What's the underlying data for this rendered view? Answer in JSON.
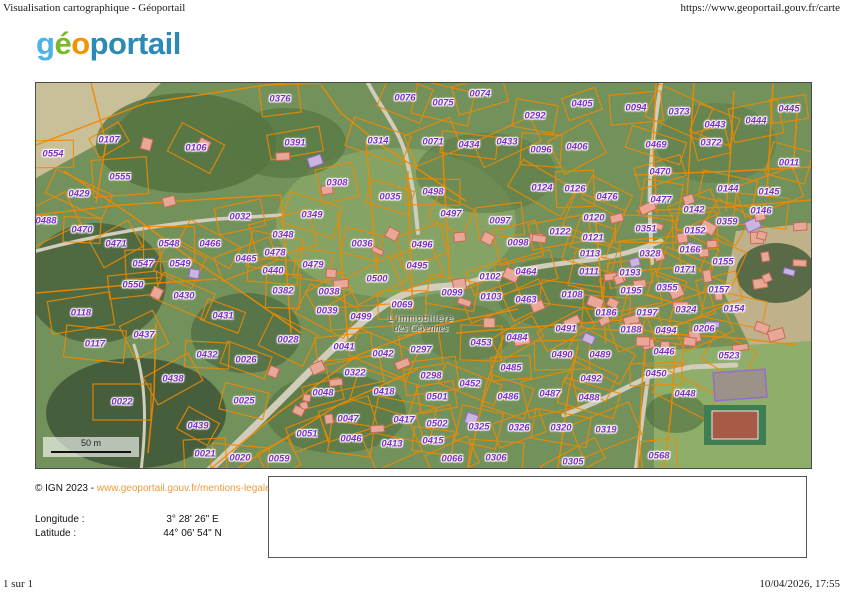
{
  "header": {
    "doc_title": "Visualisation cartographique - Géoportail",
    "url": "https://www.geoportail.gouv.fr/carte"
  },
  "logo": {
    "parts": [
      {
        "t": "g",
        "c": "#4db3e6"
      },
      {
        "t": "é",
        "c": "#7ab829"
      },
      {
        "t": "o",
        "c": "#f29400"
      },
      {
        "t": "portail",
        "c": "#2d89b5"
      }
    ]
  },
  "map": {
    "colors": {
      "parcel_line": "#f08a00",
      "parcel_label": "#7d2cc8",
      "building_fill": "#e7a898",
      "building_stroke": "#c96a57",
      "public_building_stroke": "#9a6ad0",
      "marker": "#f2a33c"
    },
    "place_label": {
      "line1": "L'immobilière",
      "line2": "des Cévennes"
    },
    "scale_bar": {
      "label": "50 m"
    },
    "parcels": [
      {
        "t": "0107",
        "x": 73,
        "y": 57
      },
      {
        "t": "0554",
        "x": 17,
        "y": 71
      },
      {
        "t": "0106",
        "x": 160,
        "y": 65
      },
      {
        "t": "0555",
        "x": 84,
        "y": 94
      },
      {
        "t": "0429",
        "x": 43,
        "y": 111
      },
      {
        "t": "0376",
        "x": 244,
        "y": 16
      },
      {
        "t": "0076",
        "x": 369,
        "y": 15
      },
      {
        "t": "0391",
        "x": 259,
        "y": 60
      },
      {
        "t": "0314",
        "x": 342,
        "y": 58
      },
      {
        "t": "0308",
        "x": 301,
        "y": 100
      },
      {
        "t": "0035",
        "x": 354,
        "y": 114
      },
      {
        "t": "0074",
        "x": 444,
        "y": 11
      },
      {
        "t": "0075",
        "x": 407,
        "y": 20
      },
      {
        "t": "0405",
        "x": 546,
        "y": 21
      },
      {
        "t": "0292",
        "x": 499,
        "y": 33
      },
      {
        "t": "0071",
        "x": 397,
        "y": 59
      },
      {
        "t": "0434",
        "x": 433,
        "y": 62
      },
      {
        "t": "0433",
        "x": 471,
        "y": 59
      },
      {
        "t": "0096",
        "x": 505,
        "y": 67
      },
      {
        "t": "0406",
        "x": 541,
        "y": 64
      },
      {
        "t": "0498",
        "x": 397,
        "y": 109
      },
      {
        "t": "0124",
        "x": 506,
        "y": 105
      },
      {
        "t": "0126",
        "x": 539,
        "y": 106
      },
      {
        "t": "0476",
        "x": 571,
        "y": 114
      },
      {
        "t": "0094",
        "x": 600,
        "y": 25
      },
      {
        "t": "0373",
        "x": 643,
        "y": 29
      },
      {
        "t": "0445",
        "x": 753,
        "y": 26
      },
      {
        "t": "0443",
        "x": 679,
        "y": 42
      },
      {
        "t": "0444",
        "x": 720,
        "y": 38
      },
      {
        "t": "0469",
        "x": 620,
        "y": 62
      },
      {
        "t": "0372",
        "x": 675,
        "y": 60
      },
      {
        "t": "0011",
        "x": 753,
        "y": 80
      },
      {
        "t": "0470",
        "x": 624,
        "y": 89
      },
      {
        "t": "0144",
        "x": 692,
        "y": 106
      },
      {
        "t": "0145",
        "x": 733,
        "y": 109
      },
      {
        "t": "0477",
        "x": 625,
        "y": 117
      },
      {
        "t": "0142",
        "x": 658,
        "y": 127
      },
      {
        "t": "0146",
        "x": 725,
        "y": 128
      },
      {
        "t": "0488",
        "x": 10,
        "y": 138
      },
      {
        "t": "0470",
        "x": 46,
        "y": 147
      },
      {
        "t": "0471",
        "x": 80,
        "y": 161
      },
      {
        "t": "0548",
        "x": 133,
        "y": 161
      },
      {
        "t": "0466",
        "x": 174,
        "y": 161
      },
      {
        "t": "0547",
        "x": 107,
        "y": 181
      },
      {
        "t": "0549",
        "x": 144,
        "y": 181
      },
      {
        "t": "0550",
        "x": 97,
        "y": 202
      },
      {
        "t": "0430",
        "x": 148,
        "y": 213
      },
      {
        "t": "0118",
        "x": 45,
        "y": 230
      },
      {
        "t": "0431",
        "x": 187,
        "y": 233
      },
      {
        "t": "0032",
        "x": 204,
        "y": 134
      },
      {
        "t": "0349",
        "x": 276,
        "y": 132
      },
      {
        "t": "0348",
        "x": 247,
        "y": 152
      },
      {
        "t": "0036",
        "x": 326,
        "y": 161
      },
      {
        "t": "0496",
        "x": 386,
        "y": 162
      },
      {
        "t": "0478",
        "x": 239,
        "y": 170
      },
      {
        "t": "0465",
        "x": 210,
        "y": 176
      },
      {
        "t": "0479",
        "x": 277,
        "y": 182
      },
      {
        "t": "0495",
        "x": 381,
        "y": 183
      },
      {
        "t": "0440",
        "x": 237,
        "y": 188
      },
      {
        "t": "0500",
        "x": 341,
        "y": 196
      },
      {
        "t": "0382",
        "x": 247,
        "y": 208
      },
      {
        "t": "0038",
        "x": 293,
        "y": 209
      },
      {
        "t": "0069",
        "x": 366,
        "y": 222
      },
      {
        "t": "0039",
        "x": 291,
        "y": 228
      },
      {
        "t": "0499",
        "x": 325,
        "y": 234
      },
      {
        "t": "0497",
        "x": 415,
        "y": 131
      },
      {
        "t": "0097",
        "x": 464,
        "y": 138
      },
      {
        "t": "0120",
        "x": 558,
        "y": 135
      },
      {
        "t": "0122",
        "x": 524,
        "y": 149
      },
      {
        "t": "0121",
        "x": 557,
        "y": 155
      },
      {
        "t": "0098",
        "x": 482,
        "y": 160
      },
      {
        "t": "0113",
        "x": 554,
        "y": 171
      },
      {
        "t": "0464",
        "x": 490,
        "y": 189
      },
      {
        "t": "0111",
        "x": 553,
        "y": 189
      },
      {
        "t": "0102",
        "x": 454,
        "y": 194
      },
      {
        "t": "0099",
        "x": 416,
        "y": 210
      },
      {
        "t": "0103",
        "x": 455,
        "y": 214
      },
      {
        "t": "0108",
        "x": 536,
        "y": 212
      },
      {
        "t": "0463",
        "x": 490,
        "y": 217
      },
      {
        "t": "0186",
        "x": 570,
        "y": 230
      },
      {
        "t": "0491",
        "x": 530,
        "y": 246
      },
      {
        "t": "0351",
        "x": 610,
        "y": 146
      },
      {
        "t": "0359",
        "x": 691,
        "y": 139
      },
      {
        "t": "0152",
        "x": 659,
        "y": 148
      },
      {
        "t": "0166",
        "x": 654,
        "y": 167
      },
      {
        "t": "0328",
        "x": 614,
        "y": 171
      },
      {
        "t": "0155",
        "x": 687,
        "y": 179
      },
      {
        "t": "0193",
        "x": 594,
        "y": 190
      },
      {
        "t": "0171",
        "x": 649,
        "y": 187
      },
      {
        "t": "0195",
        "x": 595,
        "y": 208
      },
      {
        "t": "0355",
        "x": 631,
        "y": 205
      },
      {
        "t": "0157",
        "x": 683,
        "y": 207
      },
      {
        "t": "0197",
        "x": 611,
        "y": 230
      },
      {
        "t": "0324",
        "x": 650,
        "y": 227
      },
      {
        "t": "0154",
        "x": 698,
        "y": 226
      },
      {
        "t": "0188",
        "x": 595,
        "y": 247
      },
      {
        "t": "0494",
        "x": 630,
        "y": 248
      },
      {
        "t": "0206",
        "x": 668,
        "y": 246
      },
      {
        "t": "0117",
        "x": 59,
        "y": 261
      },
      {
        "t": "0437",
        "x": 108,
        "y": 252
      },
      {
        "t": "0432",
        "x": 171,
        "y": 272
      },
      {
        "t": "0438",
        "x": 137,
        "y": 296
      },
      {
        "t": "0022",
        "x": 86,
        "y": 319
      },
      {
        "t": "0439",
        "x": 162,
        "y": 343
      },
      {
        "t": "0021",
        "x": 169,
        "y": 371
      },
      {
        "t": "0028",
        "x": 252,
        "y": 257
      },
      {
        "t": "0041",
        "x": 308,
        "y": 264
      },
      {
        "t": "0042",
        "x": 347,
        "y": 271
      },
      {
        "t": "0297",
        "x": 385,
        "y": 267
      },
      {
        "t": "0026",
        "x": 210,
        "y": 277
      },
      {
        "t": "0322",
        "x": 319,
        "y": 290
      },
      {
        "t": "0418",
        "x": 348,
        "y": 309
      },
      {
        "t": "0048",
        "x": 287,
        "y": 310
      },
      {
        "t": "0025",
        "x": 208,
        "y": 318
      },
      {
        "t": "0047",
        "x": 312,
        "y": 336
      },
      {
        "t": "0417",
        "x": 368,
        "y": 337
      },
      {
        "t": "0051",
        "x": 271,
        "y": 351
      },
      {
        "t": "0046",
        "x": 315,
        "y": 356
      },
      {
        "t": "0413",
        "x": 356,
        "y": 361
      },
      {
        "t": "0020",
        "x": 204,
        "y": 375
      },
      {
        "t": "0059",
        "x": 243,
        "y": 376
      },
      {
        "t": "0453",
        "x": 445,
        "y": 260
      },
      {
        "t": "0484",
        "x": 481,
        "y": 255
      },
      {
        "t": "0490",
        "x": 526,
        "y": 272
      },
      {
        "t": "0489",
        "x": 564,
        "y": 272
      },
      {
        "t": "0485",
        "x": 475,
        "y": 285
      },
      {
        "t": "0492",
        "x": 555,
        "y": 296
      },
      {
        "t": "0298",
        "x": 395,
        "y": 293
      },
      {
        "t": "0452",
        "x": 434,
        "y": 301
      },
      {
        "t": "0501",
        "x": 401,
        "y": 314
      },
      {
        "t": "0486",
        "x": 472,
        "y": 314
      },
      {
        "t": "0487",
        "x": 514,
        "y": 311
      },
      {
        "t": "0488",
        "x": 553,
        "y": 315
      },
      {
        "t": "0502",
        "x": 401,
        "y": 341
      },
      {
        "t": "0325",
        "x": 443,
        "y": 344
      },
      {
        "t": "0326",
        "x": 483,
        "y": 345
      },
      {
        "t": "0320",
        "x": 525,
        "y": 345
      },
      {
        "t": "0319",
        "x": 570,
        "y": 347
      },
      {
        "t": "0415",
        "x": 397,
        "y": 358
      },
      {
        "t": "0066",
        "x": 416,
        "y": 376
      },
      {
        "t": "0306",
        "x": 460,
        "y": 375
      },
      {
        "t": "0305",
        "x": 537,
        "y": 379
      },
      {
        "t": "0446",
        "x": 628,
        "y": 269
      },
      {
        "t": "0523",
        "x": 693,
        "y": 273
      },
      {
        "t": "0450",
        "x": 620,
        "y": 291
      },
      {
        "t": "0448",
        "x": 649,
        "y": 311
      },
      {
        "t": "0568",
        "x": 623,
        "y": 373
      }
    ]
  },
  "footer": {
    "copyright_prefix": "© IGN 2023 - ",
    "copyright_link": "www.geoportail.gouv.fr/mentions-legales",
    "longitude_label": "Longitude :",
    "longitude_value": "3° 28' 26\" E",
    "latitude_label": "Latitude :",
    "latitude_value": "44° 06' 54\" N"
  },
  "page_footer": {
    "page_count": "1 sur 1",
    "datetime": "10/04/2026, 17:55"
  }
}
